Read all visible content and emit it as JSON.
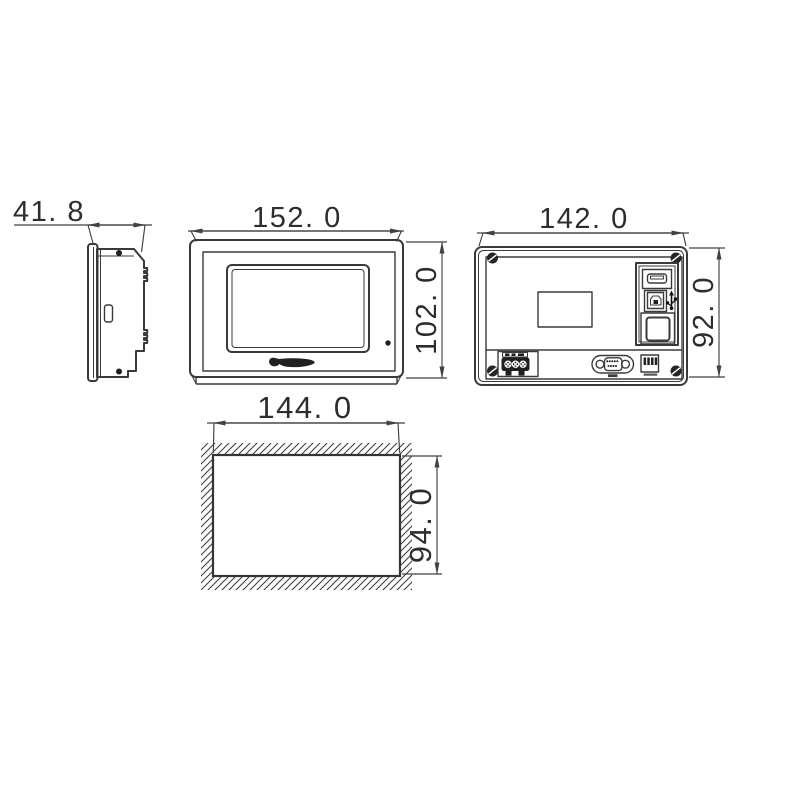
{
  "drawing": {
    "type": "technical-dimension-drawing",
    "units": "mm",
    "colors": {
      "line": "#3a3a3a",
      "background": "#ffffff",
      "dark_fill": "#202020"
    },
    "views": {
      "side": {
        "name": "side profile view",
        "depth_label": "41. 8",
        "depth_value": 41.8,
        "features": [
          "front-bezel",
          "mounting-rail-notches",
          "side-slot"
        ]
      },
      "front": {
        "name": "front view",
        "width_label": "152. 0",
        "width_value": 152.0,
        "height_label": "102. 0",
        "height_value": 102.0,
        "features": [
          "touchscreen",
          "brand-logo",
          "led-indicator"
        ]
      },
      "rear": {
        "name": "rear view",
        "width_label": "142. 0",
        "width_value": 142.0,
        "height_label": "92. 0",
        "height_value": 92.0,
        "features": [
          "corner-screws",
          "nameplate-label",
          "usb-a-port",
          "usb-b-port",
          "usb-icon",
          "card-slot",
          "power-terminal-block",
          "db9-serial-port",
          "dip-connector"
        ]
      },
      "cutout": {
        "name": "panel cutout view",
        "width_label": "144. 0",
        "width_value": 144.0,
        "height_label": "94. 0",
        "height_value": 94.0,
        "features": [
          "hatched-panel",
          "cutout-opening"
        ]
      }
    }
  }
}
